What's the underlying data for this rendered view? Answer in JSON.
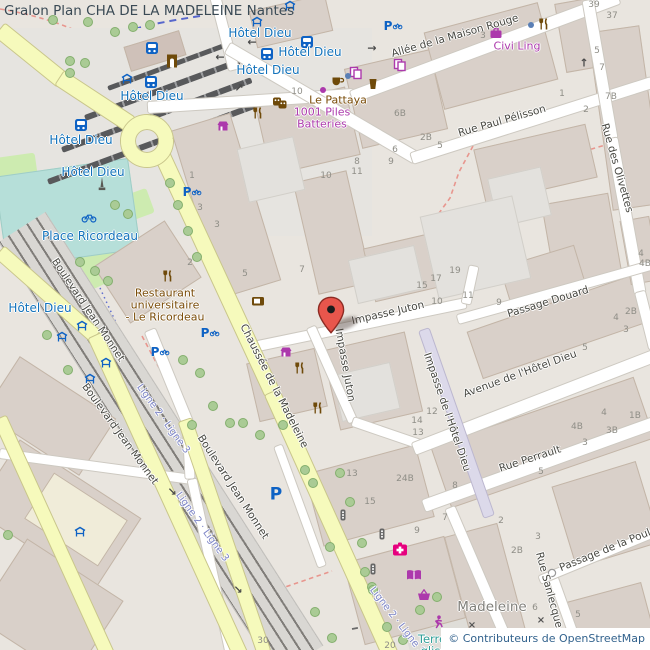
{
  "header": {
    "title": "Gralon Plan CHA DE LA MADELEINE Nantes"
  },
  "attribution": {
    "text": "© Contributeurs de OpenStreetMap"
  },
  "colors": {
    "marker_red": "#e8564c",
    "transit_blue": "#1272bb",
    "shop_purple": "#ac39ac",
    "amenity_brown": "#7a4c08",
    "health_pink": "#e6007e",
    "leisure_teal": "#2f9e97",
    "road_yellow": "#f6fabc",
    "building": "#d9d0c9",
    "tram_route_blue": "#3d51c9"
  },
  "map": {
    "street_labels": [
      {
        "text": "Allée de la Maison Rouge",
        "x": 455,
        "y": 36,
        "rot": -16
      },
      {
        "text": "Rue Paul Pélisson",
        "x": 502,
        "y": 121,
        "rot": -16
      },
      {
        "text": "Rue des Olivettes",
        "x": 617,
        "y": 168,
        "rot": 74
      },
      {
        "text": "Impasse Juton",
        "x": 388,
        "y": 313,
        "rot": -13
      },
      {
        "text": "Impasse Juton",
        "x": 345,
        "y": 365,
        "rot": 80
      },
      {
        "text": "Chaussée de la Madeleine",
        "x": 274,
        "y": 386,
        "rot": 63
      },
      {
        "text": "Impasse de l'Hôtel Dieu",
        "x": 447,
        "y": 412,
        "rot": 71
      },
      {
        "text": "Avenue de l'Hôtel Dieu",
        "x": 520,
        "y": 374,
        "rot": -20
      },
      {
        "text": "Passage Douard",
        "x": 548,
        "y": 302,
        "rot": -17
      },
      {
        "text": "Rue Perrault",
        "x": 530,
        "y": 459,
        "rot": -18
      },
      {
        "text": "Rue Sanlecque",
        "x": 549,
        "y": 590,
        "rot": 75
      },
      {
        "text": "Passage de la Poule",
        "x": 608,
        "y": 549,
        "rot": -22
      },
      {
        "text": "Boulevard Jean Monnet",
        "x": 88,
        "y": 310,
        "rot": 56
      },
      {
        "text": "Boulevard Jean Monnet",
        "x": 120,
        "y": 434,
        "rot": 54
      },
      {
        "text": "Boulevard Jean Monnet",
        "x": 233,
        "y": 487,
        "rot": 57
      }
    ],
    "route_labels": [
      {
        "text": "Ligne 2 · Ligne 3",
        "x": 163,
        "y": 419,
        "rot": 54
      },
      {
        "text": "Ligne 2 · Ligne 3",
        "x": 202,
        "y": 527,
        "rot": 54
      },
      {
        "text": "Ligne 2 · Ligne 3",
        "x": 397,
        "y": 621,
        "rot": 52
      }
    ],
    "transit_stop_labels": [
      {
        "text": "Hôtel Dieu",
        "x": 260,
        "y": 33
      },
      {
        "text": "Hôtel Dieu",
        "x": 310,
        "y": 52
      },
      {
        "text": "Hôtel Dieu",
        "x": 268,
        "y": 70
      },
      {
        "text": "Hôtel Dieu",
        "x": 152,
        "y": 96
      },
      {
        "text": "Hôtel Dieu",
        "x": 81,
        "y": 140
      },
      {
        "text": "Hôtel Dieu",
        "x": 93,
        "y": 172
      },
      {
        "text": "Hôtel Dieu",
        "x": 40,
        "y": 308
      }
    ],
    "place_labels": [
      {
        "text": "Place Ricordeau",
        "x": 90,
        "y": 236,
        "kind": "transit"
      },
      {
        "text": "Restaurant",
        "x": 165,
        "y": 293,
        "kind": "brown"
      },
      {
        "text": "universitaire",
        "x": 165,
        "y": 305,
        "kind": "brown"
      },
      {
        "text": "- Le Ricordeau",
        "x": 165,
        "y": 317,
        "kind": "brown"
      },
      {
        "text": "Le Pattaya",
        "x": 338,
        "y": 100,
        "kind": "brown"
      },
      {
        "text": "1001 Piles",
        "x": 322,
        "y": 112,
        "kind": "purple"
      },
      {
        "text": "Batteries",
        "x": 322,
        "y": 124,
        "kind": "purple"
      },
      {
        "text": "Civi Ling",
        "x": 517,
        "y": 46,
        "kind": "purple"
      },
      {
        "text": "Madeleine",
        "x": 492,
        "y": 607,
        "kind": "locality"
      },
      {
        "text": "Terre de",
        "x": 441,
        "y": 639,
        "kind": "teal"
      },
      {
        "text": "glisse",
        "x": 437,
        "y": 651,
        "kind": "teal"
      }
    ],
    "house_numbers": [
      {
        "t": "39",
        "x": 594,
        "y": 5
      },
      {
        "t": "37",
        "x": 612,
        "y": 16
      },
      {
        "t": "3",
        "x": 483,
        "y": 36
      },
      {
        "t": "5",
        "x": 597,
        "y": 51
      },
      {
        "t": "7",
        "x": 602,
        "y": 68
      },
      {
        "t": "7B",
        "x": 611,
        "y": 97
      },
      {
        "t": "1",
        "x": 562,
        "y": 94
      },
      {
        "t": "2",
        "x": 586,
        "y": 110
      },
      {
        "t": "6B",
        "x": 400,
        "y": 114
      },
      {
        "t": "2B",
        "x": 426,
        "y": 138
      },
      {
        "t": "5",
        "x": 440,
        "y": 146
      },
      {
        "t": "10",
        "x": 297,
        "y": 92
      },
      {
        "t": "6",
        "x": 395,
        "y": 150
      },
      {
        "t": "8",
        "x": 357,
        "y": 162
      },
      {
        "t": "9",
        "x": 391,
        "y": 162
      },
      {
        "t": "11",
        "x": 357,
        "y": 172
      },
      {
        "t": "10",
        "x": 326,
        "y": 176
      },
      {
        "t": "1",
        "x": 192,
        "y": 176
      },
      {
        "t": "3",
        "x": 200,
        "y": 208
      },
      {
        "t": "3",
        "x": 217,
        "y": 225
      },
      {
        "t": "2",
        "x": 190,
        "y": 263
      },
      {
        "t": "5",
        "x": 245,
        "y": 274
      },
      {
        "t": "7",
        "x": 302,
        "y": 270
      },
      {
        "t": "15",
        "x": 422,
        "y": 286
      },
      {
        "t": "17",
        "x": 436,
        "y": 279
      },
      {
        "t": "19",
        "x": 455,
        "y": 271
      },
      {
        "t": "10",
        "x": 437,
        "y": 302
      },
      {
        "t": "11",
        "x": 468,
        "y": 296
      },
      {
        "t": "9",
        "x": 499,
        "y": 303
      },
      {
        "t": "4",
        "x": 616,
        "y": 318
      },
      {
        "t": "2B",
        "x": 631,
        "y": 312
      },
      {
        "t": "3",
        "x": 626,
        "y": 330
      },
      {
        "t": "5",
        "x": 585,
        "y": 348
      },
      {
        "t": "14",
        "x": 417,
        "y": 421
      },
      {
        "t": "12",
        "x": 432,
        "y": 412
      },
      {
        "t": "13",
        "x": 418,
        "y": 433
      },
      {
        "t": "13",
        "x": 352,
        "y": 474
      },
      {
        "t": "24B",
        "x": 405,
        "y": 479
      },
      {
        "t": "15",
        "x": 370,
        "y": 502
      },
      {
        "t": "8",
        "x": 455,
        "y": 486
      },
      {
        "t": "4",
        "x": 604,
        "y": 413
      },
      {
        "t": "1B",
        "x": 635,
        "y": 416
      },
      {
        "t": "4B",
        "x": 577,
        "y": 427
      },
      {
        "t": "3B",
        "x": 612,
        "y": 431
      },
      {
        "t": "3",
        "x": 585,
        "y": 443
      },
      {
        "t": "5",
        "x": 541,
        "y": 472
      },
      {
        "t": "7",
        "x": 445,
        "y": 518
      },
      {
        "t": "2",
        "x": 501,
        "y": 521
      },
      {
        "t": "3",
        "x": 538,
        "y": 537
      },
      {
        "t": "2B",
        "x": 517,
        "y": 551
      },
      {
        "t": "6",
        "x": 535,
        "y": 608
      },
      {
        "t": "5",
        "x": 578,
        "y": 615
      },
      {
        "t": "9",
        "x": 417,
        "y": 531
      },
      {
        "t": "30",
        "x": 263,
        "y": 641
      },
      {
        "t": "20",
        "x": 390,
        "y": 646
      },
      {
        "t": "4",
        "x": 641,
        "y": 254
      },
      {
        "t": "4B",
        "x": 645,
        "y": 264
      }
    ],
    "icons": [
      {
        "type": "bus-icon",
        "x": 152,
        "y": 48
      },
      {
        "type": "bus-icon",
        "x": 307,
        "y": 42
      },
      {
        "type": "bus-icon",
        "x": 267,
        "y": 54
      },
      {
        "type": "bus-icon",
        "x": 151,
        "y": 82
      },
      {
        "type": "bus-icon",
        "x": 81,
        "y": 125
      },
      {
        "type": "tram-shelter-icon",
        "x": 257,
        "y": 22
      },
      {
        "type": "tram-shelter-icon",
        "x": 290,
        "y": 6
      },
      {
        "type": "tram-shelter-icon",
        "x": 127,
        "y": 79
      },
      {
        "type": "tram-shelter-icon",
        "x": 62,
        "y": 337
      },
      {
        "type": "tram-shelter-icon",
        "x": 82,
        "y": 326
      },
      {
        "type": "tram-shelter-icon",
        "x": 106,
        "y": 363
      },
      {
        "type": "tram-shelter-icon",
        "x": 90,
        "y": 379
      },
      {
        "type": "tram-sh elter-icon",
        "x": 80,
        "y": 532
      },
      {
        "type": "parking-bike-icon",
        "x": 393,
        "y": 26
      },
      {
        "type": "parking-bike-icon",
        "x": 192,
        "y": 192
      },
      {
        "type": "parking-bike-icon",
        "x": 210,
        "y": 333
      },
      {
        "type": "parking-bike-icon",
        "x": 160,
        "y": 352
      },
      {
        "type": "parking-icon",
        "x": 276,
        "y": 495
      },
      {
        "type": "restaurant-icon",
        "x": 168,
        "y": 276
      },
      {
        "type": "restaurant-icon",
        "x": 258,
        "y": 113
      },
      {
        "type": "restaurant-icon",
        "x": 300,
        "y": 368
      },
      {
        "type": "restaurant-icon",
        "x": 318,
        "y": 408
      },
      {
        "type": "restaurant-icon",
        "x": 544,
        "y": 24
      },
      {
        "type": "cafe-icon",
        "x": 338,
        "y": 81
      },
      {
        "type": "beer-icon",
        "x": 373,
        "y": 84
      },
      {
        "type": "theatre-icon",
        "x": 280,
        "y": 103
      },
      {
        "type": "shop-icon",
        "x": 223,
        "y": 126
      },
      {
        "type": "shop-icon",
        "x": 286,
        "y": 352
      },
      {
        "type": "copyshop-icon",
        "x": 400,
        "y": 65
      },
      {
        "type": "copyshop-icon",
        "x": 356,
        "y": 73
      },
      {
        "type": "suitcase-icon",
        "x": 496,
        "y": 33
      },
      {
        "type": "poi-dot-icon",
        "x": 323,
        "y": 90
      },
      {
        "type": "poi-dot-blue-icon",
        "x": 348,
        "y": 76
      },
      {
        "type": "poi-dot-blue-icon",
        "x": 531,
        "y": 25
      },
      {
        "type": "doorway-icon",
        "x": 172,
        "y": 61
      },
      {
        "type": "screen-icon",
        "x": 258,
        "y": 302
      },
      {
        "type": "monument-icon",
        "x": 102,
        "y": 184
      },
      {
        "type": "bicycle-icon",
        "x": 89,
        "y": 218
      },
      {
        "type": "pharmacy-icon",
        "x": 400,
        "y": 549
      },
      {
        "type": "library-icon",
        "x": 414,
        "y": 575
      },
      {
        "type": "supermarket-icon",
        "x": 424,
        "y": 595
      },
      {
        "type": "sports-icon",
        "x": 438,
        "y": 622
      },
      {
        "type": "traffic-signal-icon",
        "x": 343,
        "y": 515
      },
      {
        "type": "traffic-signal-icon",
        "x": 382,
        "y": 534
      },
      {
        "type": "traffic-signal-icon",
        "x": 373,
        "y": 569
      },
      {
        "type": "node-dot-icon",
        "x": 552,
        "y": 573
      },
      {
        "type": "level-crossing-icon",
        "x": 472,
        "y": 626,
        "g": "×"
      },
      {
        "type": "level-crossing-icon",
        "x": 541,
        "y": 621,
        "g": "×"
      },
      {
        "type": "oneway-arrow-icon",
        "x": 252,
        "y": 42,
        "g": "←"
      },
      {
        "type": "oneway-arrow-icon",
        "x": 220,
        "y": 57,
        "g": "←"
      },
      {
        "type": "oneway-arrow-icon",
        "x": 239,
        "y": 88,
        "g": "↗"
      },
      {
        "type": "oneway-arrow-icon",
        "x": 372,
        "y": 48,
        "g": "→"
      },
      {
        "type": "oneway-arrow-icon",
        "x": 584,
        "y": 63,
        "g": "↑"
      },
      {
        "type": "oneway-arrow-icon",
        "x": 172,
        "y": 492,
        "g": "↘"
      },
      {
        "type": "oneway-arrow-icon",
        "x": 238,
        "y": 590,
        "g": "↘"
      }
    ],
    "marker": {
      "name": "location-marker",
      "x": 331,
      "y": 333
    }
  }
}
